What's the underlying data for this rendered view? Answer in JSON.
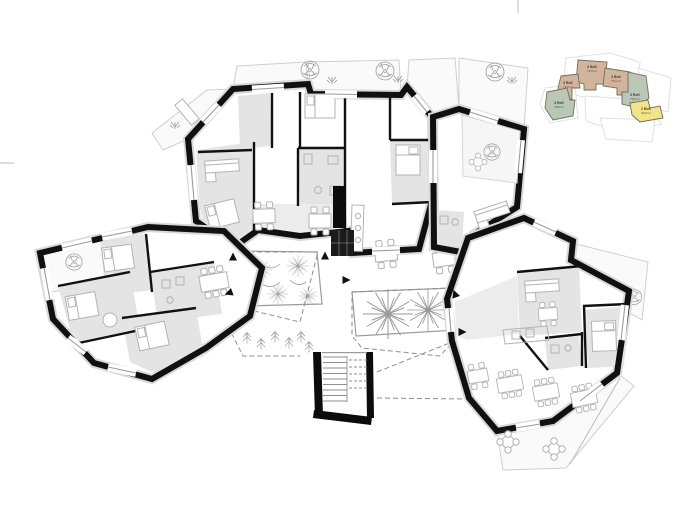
{
  "drawing_title": "floor-plan",
  "palette": {
    "wall": "#101010",
    "room_gray": "#e4e4e4",
    "terrace_gray": "#fafafa",
    "furniture_line": "#b3b3b3",
    "courtyard_dash": "#8f8f8f",
    "keyplan_tan": "#d2b49c",
    "keyplan_green": "#b9c8b4",
    "keyplan_yellow": "#f2e388"
  },
  "keyplan": {
    "units": [
      {
        "id": "unit-a",
        "label": "2 RoK",
        "area": "74,5 m²",
        "color": "#d2b49c"
      },
      {
        "id": "unit-b",
        "label": "3 RoK",
        "area": "79,2 m²",
        "color": "#d2b49c"
      },
      {
        "id": "unit-c",
        "label": "2 RoK",
        "area": "74,6 m²",
        "color": "#d2b49c"
      },
      {
        "id": "unit-d",
        "label": "3 RoK",
        "area": "79,6 m²",
        "color": "#b9c8b4"
      },
      {
        "id": "unit-e",
        "label": "3 RoK",
        "area": "79,8 m²",
        "color": "#b9c8b4"
      },
      {
        "id": "unit-f",
        "label": "2 RoK",
        "area": "49,9 m²",
        "color": "#f2e388"
      }
    ]
  }
}
